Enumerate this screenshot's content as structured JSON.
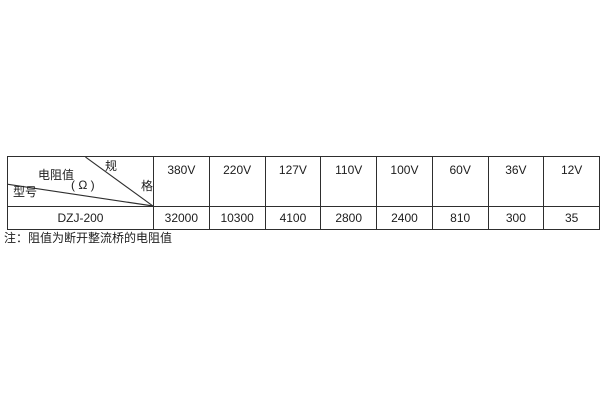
{
  "colors": {
    "background": "#ffffff",
    "border": "#2e2e2e",
    "text": "#1c1c1c"
  },
  "table": {
    "corner": {
      "spec_char1": "规",
      "spec_char2": "格",
      "middle_label": "电阻值",
      "unit_label": "( Ω )",
      "bottom_label": "型号"
    },
    "voltages": [
      "380V",
      "220V",
      "127V",
      "110V",
      "100V",
      "60V",
      "36V",
      "12V"
    ],
    "row": {
      "model": "DZJ-200",
      "values": [
        "32000",
        "10300",
        "4100",
        "2800",
        "2400",
        "810",
        "300",
        "35"
      ]
    }
  },
  "note": "注：阻值为断开整流桥的电阻值"
}
